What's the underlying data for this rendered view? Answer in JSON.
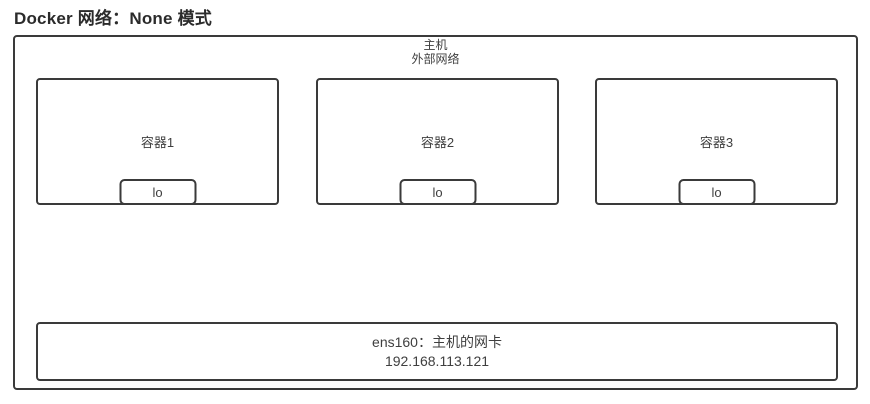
{
  "title": "Docker 网络：None 模式",
  "host": {
    "label_line1": "主机",
    "label_line2": "外部网络"
  },
  "containers": [
    {
      "label": "容器1",
      "interface": "lo"
    },
    {
      "label": "容器2",
      "interface": "lo"
    },
    {
      "label": "容器3",
      "interface": "lo"
    }
  ],
  "nic": {
    "line1": "ens160：主机的网卡",
    "line2": "192.168.113.121"
  },
  "colors": {
    "border": "#3a3a3a",
    "text": "#3f3f3f",
    "background": "#ffffff"
  }
}
